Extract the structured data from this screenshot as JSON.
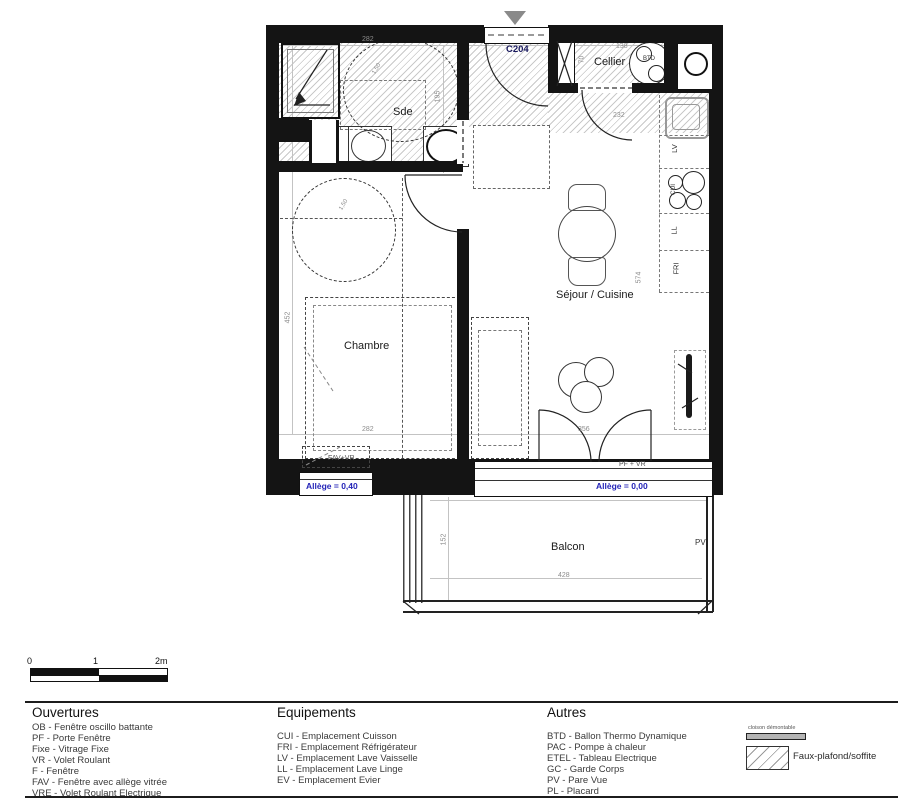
{
  "plan": {
    "entrance_label": "C204",
    "room_labels": {
      "sde": "Sde",
      "cellier": "Cellier",
      "chambre": "Chambre",
      "sejour": "Séjour / Cuisine",
      "balcon": "Balcon"
    },
    "equipment_labels": {
      "btd": "BTD",
      "lv": "LV",
      "cui": "CUI",
      "ll": "LL",
      "fri": "FRI",
      "pv": "PV"
    },
    "window_labels": {
      "fav_vr": "FAV+VR",
      "pf_vr": "PF + VR",
      "allege_left": "Allège = 0,40",
      "allege_right": "Allège = 0,00"
    },
    "dimensions": {
      "sde_width": "282",
      "sde_depth": "195",
      "cellier_width": "138",
      "cellier_depth": "70",
      "hall_door": "232",
      "sejour_height": "574",
      "chambre_height": "452",
      "chambre_width": "282",
      "bay_width": "356",
      "balcon_depth": "152",
      "balcon_width": "428",
      "turn_circle": "1,50"
    }
  },
  "scale_bar": {
    "tick0": "0",
    "tick1": "1",
    "tick2": "2m"
  },
  "legend": {
    "ouvertures": {
      "title": "Ouvertures",
      "items": [
        "OB - Fenêtre oscillo battante",
        "PF - Porte Fenêtre",
        "Fixe - Vitrage Fixe",
        "VR - Volet Roulant",
        "F - Fenêtre",
        "FAV - Fenêtre avec allège vitrée",
        "VRE - Volet Roulant Electrique"
      ]
    },
    "equipements": {
      "title": "Equipements",
      "items": [
        "CUI - Emplacement Cuisson",
        "FRI - Emplacement Réfrigérateur",
        "LV - Emplacement Lave Vaisselle",
        "LL - Emplacement Lave Linge",
        "EV - Emplacement Evier"
      ]
    },
    "autres": {
      "title": "Autres",
      "items": [
        "BTD - Ballon Thermo Dynamique",
        "PAC - Pompe à chaleur",
        "ETEL - Tableau Electrique",
        "GC - Garde Corps",
        "PV - Pare Vue",
        "PL - Placard"
      ]
    },
    "symbols": {
      "cloison": "cloison démontable",
      "faux_plafond": "Faux-plafond/soffite"
    }
  },
  "colors": {
    "wall": "#141414",
    "accent_blue": "#2424b8",
    "dim_gray": "#8c8c8c",
    "hatch_gray": "#c9c9c9"
  }
}
